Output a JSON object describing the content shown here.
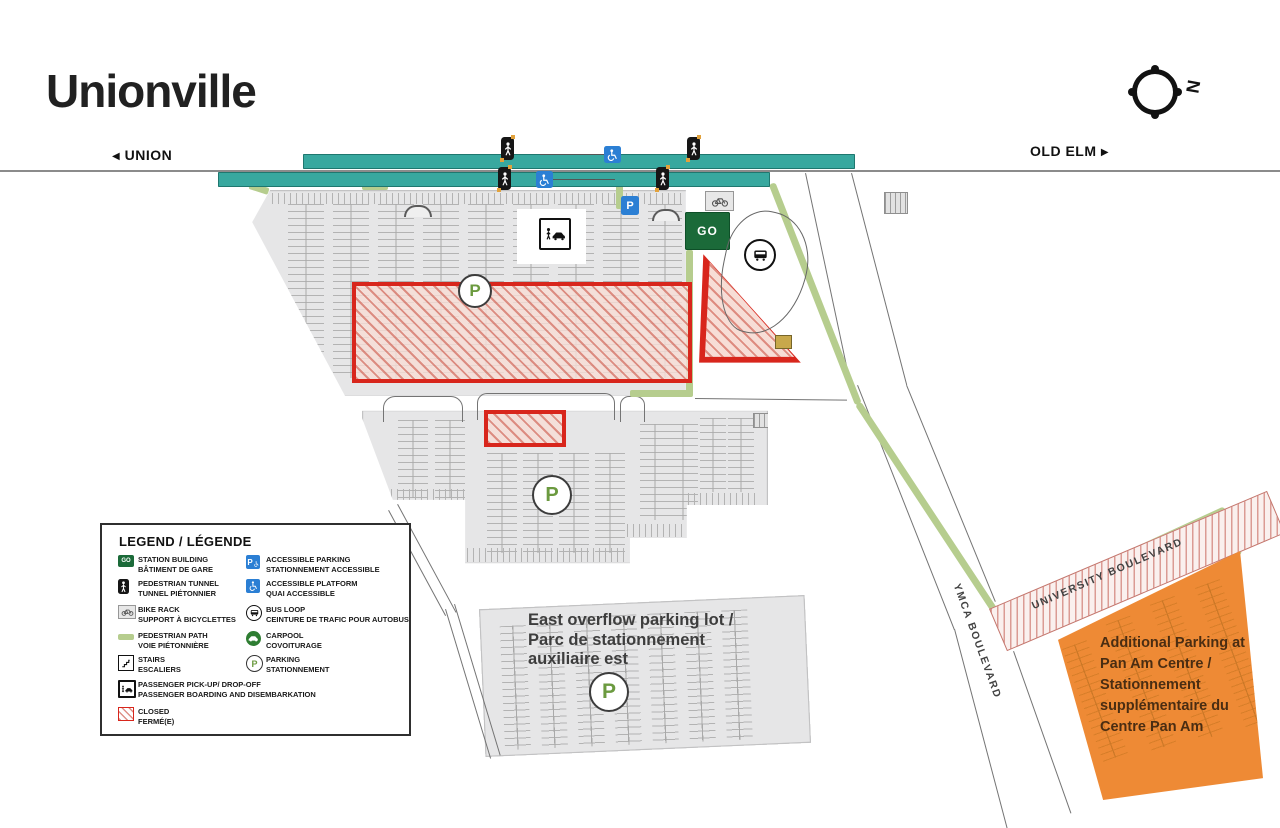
{
  "header": {
    "title": "Unionville",
    "nav_left": "UNION",
    "nav_right": "OLD ELM",
    "compass_label": "N"
  },
  "map": {
    "go_label": "GO",
    "p_label": "P",
    "east_overflow_label": "East overflow parking lot /\nParc de stationnement\nauxiliaire est",
    "pan_am_label": "Additional Parking at\nPan Am Centre /\nStationnement\nsupplémentaire du\nCentre Pan Am",
    "ymca_blvd_label": "YMCA BOULEVARD",
    "university_blvd_label": "UNIVERSITY BOULEVARD"
  },
  "legend": {
    "title": "LEGEND / LÉGENDE",
    "left": [
      {
        "name": "station-building",
        "line1": "STATION BUILDING",
        "line2": "BÂTIMENT DE GARE"
      },
      {
        "name": "pedestrian-tunnel",
        "line1": "PEDESTRIAN TUNNEL",
        "line2": "TUNNEL PIÉTONNIER"
      },
      {
        "name": "bike-rack",
        "line1": "BIKE RACK",
        "line2": "SUPPORT À BICYCLETTES"
      },
      {
        "name": "pedestrian-path",
        "line1": "PEDESTRIAN PATH",
        "line2": "VOIE PIÉTONNIÈRE"
      },
      {
        "name": "stairs",
        "line1": "STAIRS",
        "line2": "ESCALIERS"
      },
      {
        "name": "passenger-pickup-dropoff",
        "line1": "PASSENGER PICK-UP/ DROP-OFF",
        "line2": "PASSENGER BOARDING AND DISEMBARKATION"
      },
      {
        "name": "closed",
        "line1": "CLOSED",
        "line2": "FERMÉ(E)"
      }
    ],
    "right": [
      {
        "name": "accessible-parking",
        "line1": "ACCESSIBLE PARKING",
        "line2": "STATIONNEMENT ACCESSIBLE"
      },
      {
        "name": "accessible-platform",
        "line1": "ACCESSIBLE PLATFORM",
        "line2": "QUAI ACCESSIBLE"
      },
      {
        "name": "bus-loop",
        "line1": "BUS LOOP",
        "line2": "CEINTURE DE TRAFIC POUR AUTOBUS"
      },
      {
        "name": "carpool",
        "line1": "CARPOOL",
        "line2": "COVOITURAGE"
      },
      {
        "name": "parking",
        "line1": "PARKING",
        "line2": "STATIONNEMENT"
      }
    ]
  },
  "colors": {
    "platform_teal": "#38a89f",
    "path_green": "#b6cd8e",
    "closed_red": "#d8261c",
    "lot_gray": "#e6e6e7",
    "go_green": "#1b6a39",
    "accessible_blue": "#2b7fd4",
    "pan_am_orange": "#ee8a35",
    "parking_p_green": "#6b9a3f"
  }
}
